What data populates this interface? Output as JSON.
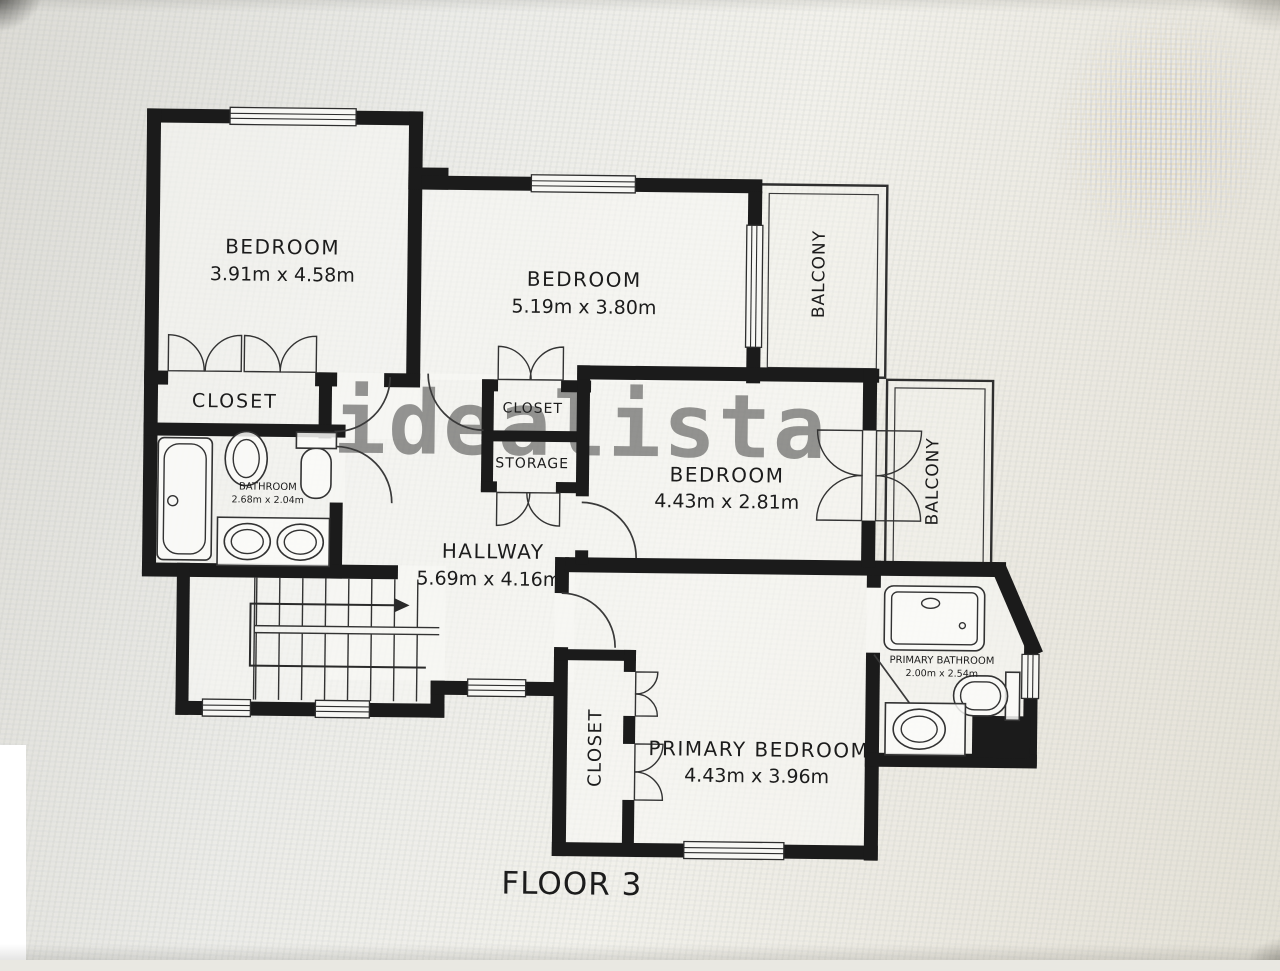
{
  "floor_plan": {
    "caption": "FLOOR 3",
    "watermark": "idealista",
    "wall_color": "#1b1b1b",
    "line_color": "#3a3a3a",
    "rooms": {
      "bedroom1": {
        "name": "BEDROOM",
        "dims": "3.91m x 4.58m"
      },
      "bedroom2": {
        "name": "BEDROOM",
        "dims": "5.19m x 3.80m"
      },
      "bedroom3": {
        "name": "BEDROOM",
        "dims": "4.43m x 2.81m"
      },
      "primary_bedroom": {
        "name": "PRIMARY BEDROOM",
        "dims": "4.43m x 3.96m"
      },
      "hallway": {
        "name": "HALLWAY",
        "dims": "5.69m x 4.16m"
      },
      "bathroom": {
        "name": "BATHROOM",
        "dims": "2.68m x 2.04m"
      },
      "primary_bathroom": {
        "name": "PRIMARY BATHROOM",
        "dims": "2.00m x 2.54m"
      },
      "closet_main": {
        "name": "CLOSET"
      },
      "closet_mid": {
        "name": "CLOSET"
      },
      "storage": {
        "name": "STORAGE"
      },
      "closet_primary": {
        "name": "CLOSET"
      },
      "balcony_top": {
        "name": "BALCONY"
      },
      "balcony_right": {
        "name": "BALCONY"
      }
    }
  }
}
